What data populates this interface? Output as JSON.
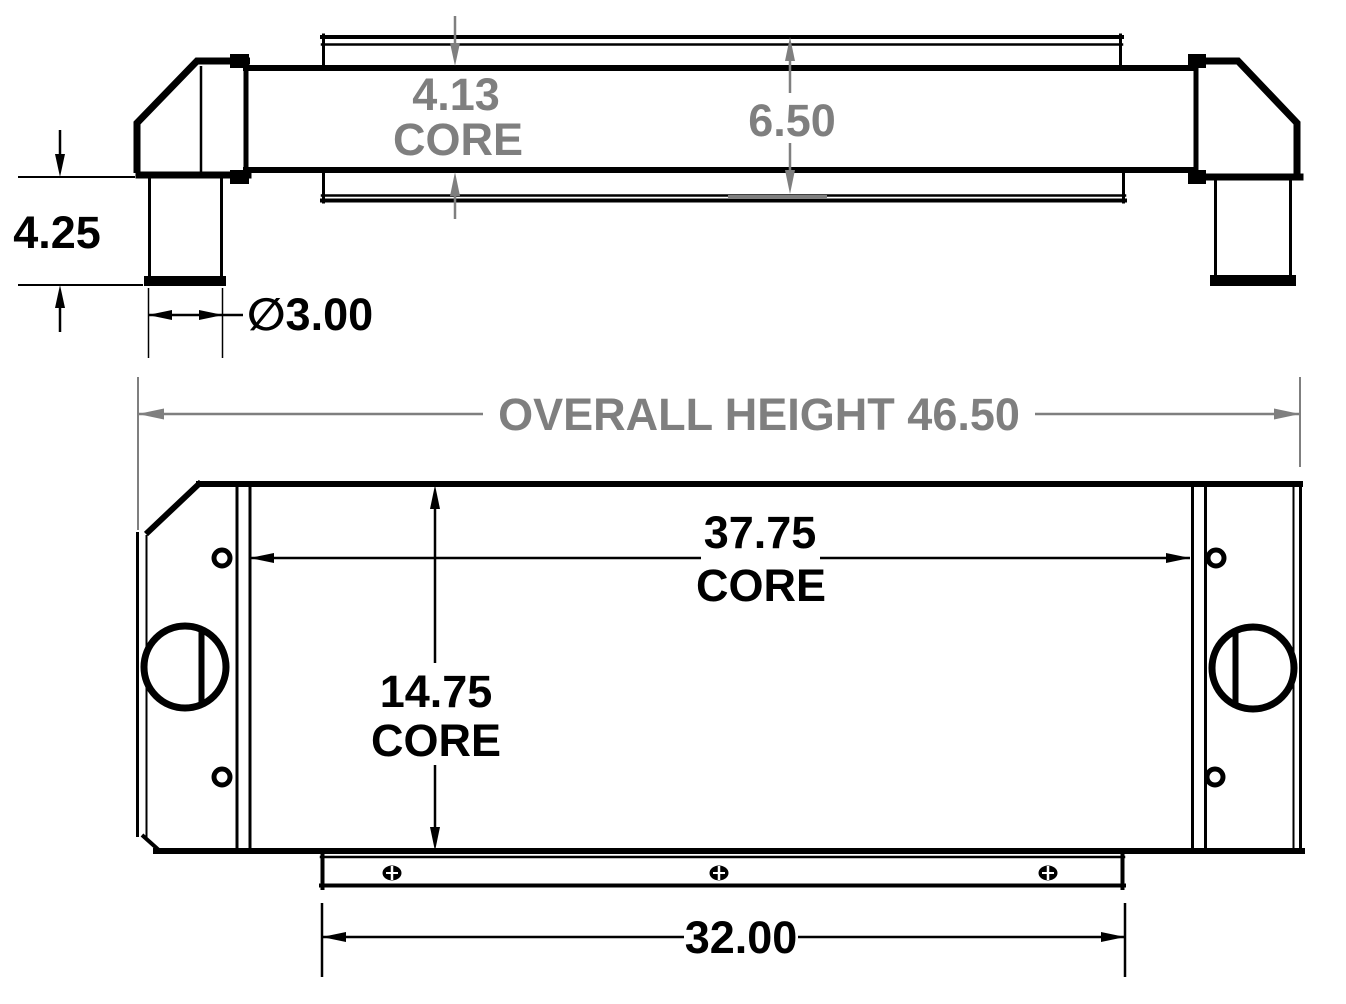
{
  "colors": {
    "line": "#000000",
    "dim": "#7f7f7f",
    "background": "#ffffff"
  },
  "dimensions": {
    "core_depth_value": "4.13",
    "core_depth_label": "CORE",
    "overall_depth": "6.50",
    "pipe_drop": "4.25",
    "pipe_diameter": "∅3.00",
    "overall_height": "OVERALL HEIGHT 46.50",
    "core_width_value": "37.75",
    "core_width_label": "CORE",
    "core_height_value": "14.75",
    "core_height_label": "CORE",
    "bracket_width": "32.00"
  }
}
